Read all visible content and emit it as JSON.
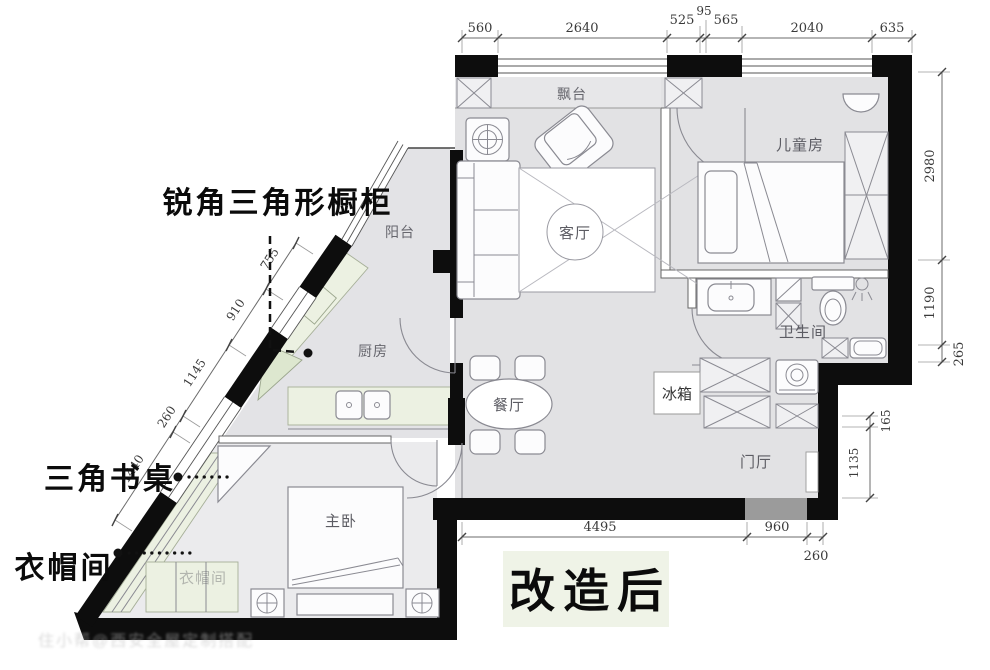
{
  "title": {
    "label": "改造后"
  },
  "annotations": {
    "cabinet": "锐角三角形橱柜",
    "desk": "三角书桌",
    "cloakroom": "衣帽间"
  },
  "rooms": {
    "bay_window": "飘台",
    "children_room": "儿童房",
    "living_room": "客厅",
    "balcony": "阳台",
    "kitchen": "厨房",
    "bathroom": "卫生间",
    "fridge": "冰箱",
    "dining_room": "餐厅",
    "entrance_hall": "门厅",
    "master_bedroom": "主卧",
    "cloakroom_room": "衣帽间"
  },
  "dimensions": {
    "top": [
      "560",
      "2640",
      "525",
      "95",
      "565",
      "2040",
      "635"
    ],
    "right_upper": [
      "2980",
      "1190",
      "265"
    ],
    "right_lower": [
      "165",
      "1135"
    ],
    "bottom": [
      "4495",
      "960",
      "260"
    ],
    "diagonal": [
      "755",
      "910",
      "1145",
      "260",
      "1440"
    ]
  },
  "watermark": "住小帮@西安全屋定制搭配",
  "colors": {
    "wall": "#0d0d0d",
    "floor": "#e2e2e4",
    "counter_green": "#ecf1e2",
    "title_bg": "#eff3e7"
  }
}
